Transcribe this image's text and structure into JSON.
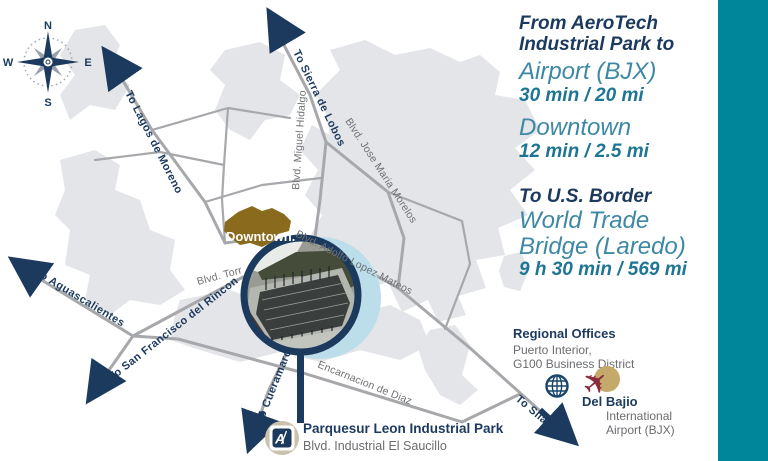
{
  "colors": {
    "navy": "#1C3A5E",
    "teal_bar": "#00869B",
    "teal_light_text": "#3D88A4",
    "teal_dark_text": "#1F7594",
    "road_gray": "#A7A8AB",
    "city_gray": "#E4E5E8",
    "downtown_brown": "#8A6B1E",
    "label_gray": "#6F7073",
    "plane_maroon": "#8C2B3D",
    "plane_tan": "#C5A96A",
    "highlight_light_blue": "#BCDEEA"
  },
  "compass": {
    "n": "N",
    "s": "S",
    "e": "E",
    "w": "W"
  },
  "icons": {
    "airplane": "✈"
  },
  "map_labels": {
    "to_sierra_de_lobos": "To Sierra de Lobos",
    "to_lagos_de_moreno": "To Lagos de Moreno",
    "to_aguascalientes": "To Aguascalientes",
    "to_san_francisco_del_rincon": "To San Francisco del Rincon",
    "to_cueramaro": "To Cueramaro",
    "to_silao": "To Silao",
    "blvd_miguel_hidalgo": "Blvd. Miguel Hidalgo",
    "blvd_jose_maria_morelos": "Blvd. Jose Maria Morelos",
    "blvd_adolfo_lopez_mateos": "Blvd. Adolfo Lopez Mateos",
    "blvd_torr": "Blvd. Torr",
    "encarnacion_de_diaz": "Encarnacion de Diaz",
    "downtown": "Downtown."
  },
  "panel": {
    "heading_line1": "From AeroTech",
    "heading_line2": "Industrial Park to",
    "destinations": [
      {
        "name": "Airport (BJX)",
        "detail": "30 min / 20 mi"
      },
      {
        "name": "Downtown",
        "detail": "12 min / 2.5 mi"
      }
    ],
    "border": {
      "heading": "To U.S. Border",
      "name_line1": "World Trade",
      "name_line2": "Bridge (Laredo)",
      "detail": "9 h 30 min / 569 mi"
    }
  },
  "regional_offices": {
    "title": "Regional Offices",
    "line1": "Puerto Interior,",
    "line2": "G100 Business District"
  },
  "airport_label": {
    "name": "Del Bajio",
    "line1": "International",
    "line2": "Airport (BJX)"
  },
  "park": {
    "logo_letter": "A",
    "name": "Parquesur Leon Industrial Park",
    "address": "Blvd. Industrial El Saucillo"
  }
}
